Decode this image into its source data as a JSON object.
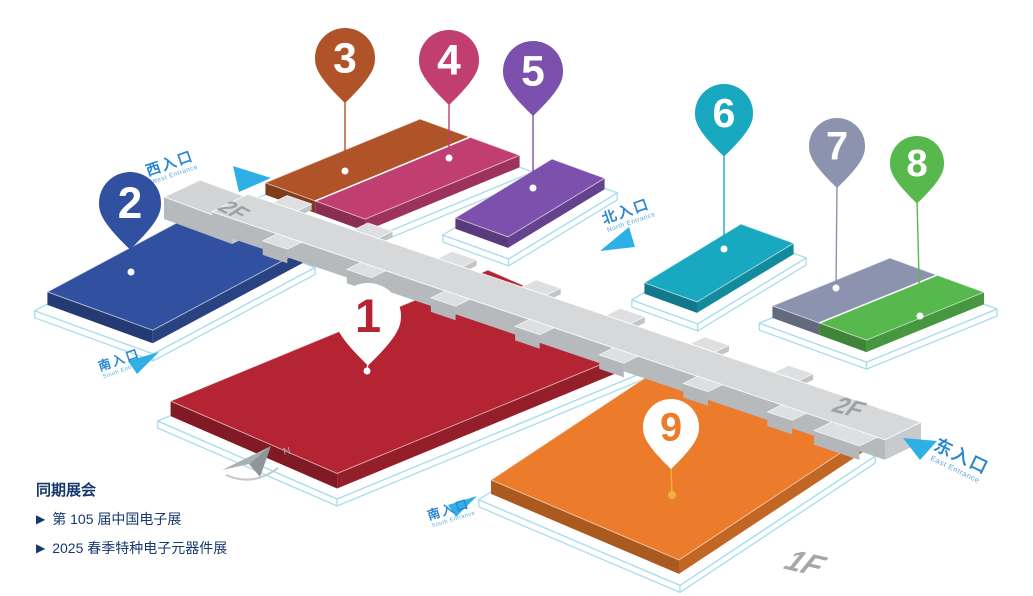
{
  "legend": {
    "title": "同期展会",
    "bullet": "▶",
    "items": [
      {
        "label": "第 105 届中国电子展"
      },
      {
        "label": "2025 春季特种电子元器件展"
      }
    ]
  },
  "floor_labels": {
    "west_2f": "2F",
    "east_2f": "2F",
    "ground_1f": "1F"
  },
  "compass": {
    "label": "N"
  },
  "entrances": {
    "west": {
      "label": "西入口",
      "label_en": "West Entrance"
    },
    "north": {
      "label": "北入口",
      "label_en": "North Entrance"
    },
    "east": {
      "label": "东入口",
      "label_en": "East Entrance"
    },
    "south_west": {
      "label": "南入口",
      "label_en": "South Entrance"
    },
    "south_center": {
      "label": "南入口",
      "label_en": "South Entrance"
    }
  },
  "halls": [
    {
      "id": "1",
      "number": "1",
      "color": "#b42433",
      "pin_style": "inverted"
    },
    {
      "id": "2",
      "number": "2",
      "color": "#31509f",
      "pin_style": "solid"
    },
    {
      "id": "3",
      "number": "3",
      "color": "#b05328",
      "pin_style": "solid"
    },
    {
      "id": "4",
      "number": "4",
      "color": "#c03e70",
      "pin_style": "solid"
    },
    {
      "id": "5",
      "number": "5",
      "color": "#7b51ad",
      "pin_style": "solid"
    },
    {
      "id": "6",
      "number": "6",
      "color": "#18a8c0",
      "pin_style": "solid"
    },
    {
      "id": "7",
      "number": "7",
      "color": "#8b93ae",
      "pin_style": "solid"
    },
    {
      "id": "8",
      "number": "8",
      "color": "#57b84e",
      "pin_style": "solid"
    },
    {
      "id": "9",
      "number": "9",
      "color": "#ec7c2b",
      "pin_style": "inverted",
      "accent": "#f2b33d"
    }
  ],
  "colors": {
    "entrance_text": "#2b87cf",
    "entrance_text_en": "#56a8dc",
    "entrance_arrow": "#2eb0e6",
    "corridor_top": "#d6d8d9",
    "corridor_front": "#b7babd",
    "base_outline": "#a7ddee",
    "floor_text": "#95999c",
    "legend_text": "#16386e",
    "compass_gray": "#a6acb0"
  }
}
